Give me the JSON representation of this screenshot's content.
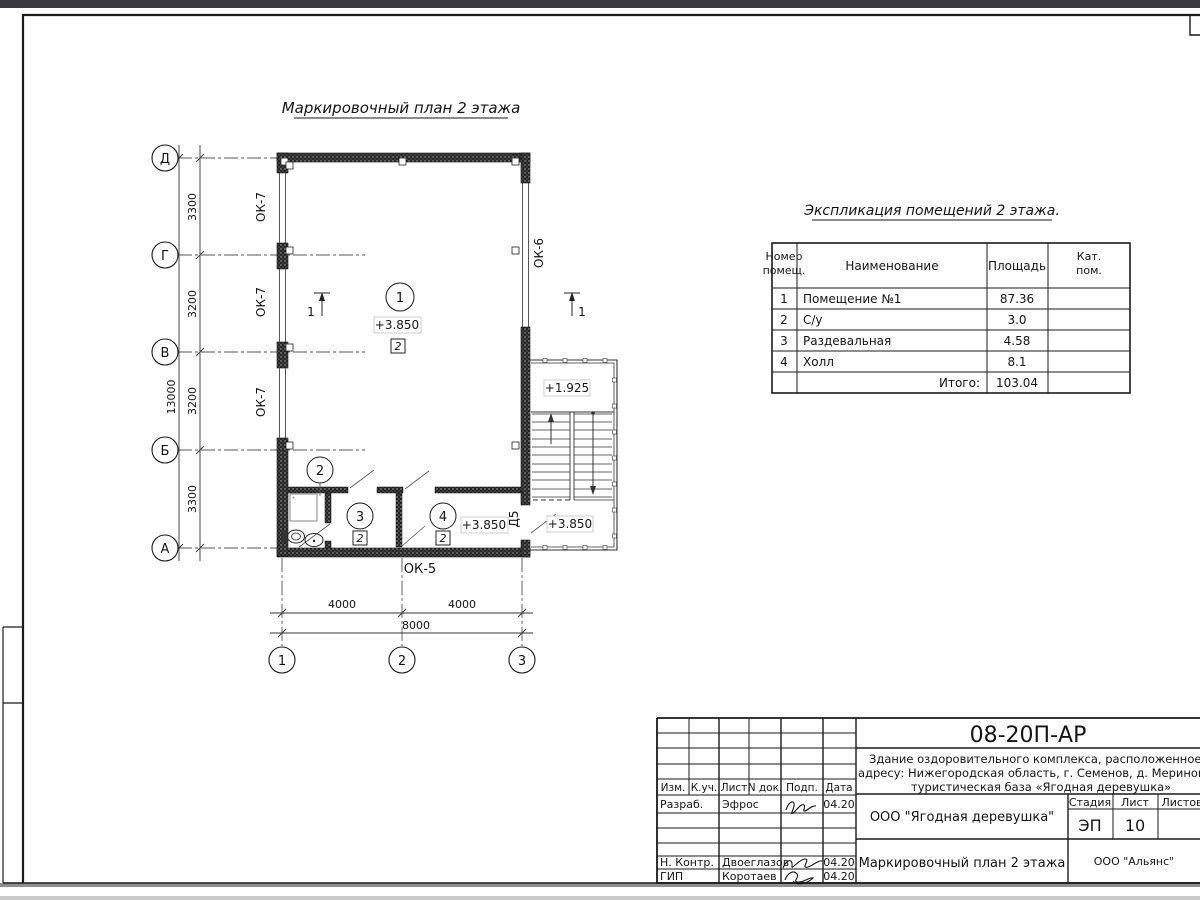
{
  "page": {
    "top_strip_color": "#3a3a3e",
    "paper_color": "#ffffff",
    "line_color": "#1a1a1a",
    "edge_band_color": "#8f8f8f",
    "outer_band_color": "#c9c9c9"
  },
  "plan": {
    "title": "Маркировочный план 2 этажа",
    "row_axes": [
      "Д",
      "Г",
      "В",
      "Б",
      "А"
    ],
    "col_axes": [
      "1",
      "2",
      "3"
    ],
    "dim_v_segments": [
      "3300",
      "3200",
      "3200",
      "3300"
    ],
    "dim_v_total": "13000",
    "dim_h_segments": [
      "4000",
      "4000"
    ],
    "dim_h_total": "8000",
    "window_left": [
      "ОК-7",
      "ОК-7",
      "ОК-7"
    ],
    "window_right": "ОК-6",
    "window_bottom": "ОК-5",
    "door": "Д5",
    "room_numbers": [
      "1",
      "2",
      "3",
      "4"
    ],
    "category_marks": [
      "2",
      "2",
      "2"
    ],
    "elevation_room1": "+3.850",
    "elevation_mid_landing": "+1.925",
    "elevation_hall": "+3.850",
    "elevation_stair_landing": "+3.850",
    "section_mark": "1"
  },
  "explication": {
    "title": "Экспликация помещений 2 этажа.",
    "headers": {
      "num1": "Номер",
      "num2": "помещ.",
      "name": "Наименование",
      "area": "Площадь",
      "cat1": "Кат.",
      "cat2": "пом."
    },
    "rows": [
      {
        "n": "1",
        "name": "Помещение №1",
        "area": "87.36"
      },
      {
        "n": "2",
        "name": "С/у",
        "area": "3.0"
      },
      {
        "n": "3",
        "name": "Раздевальная",
        "area": "4.58"
      },
      {
        "n": "4",
        "name": "Холл",
        "area": "8.1"
      }
    ],
    "total_label": "Итого:",
    "total_value": "103.04"
  },
  "titleblock": {
    "code": "08-20П-АР",
    "project_line1": "Здание оздоровительного комплекса, расположенное по",
    "project_line2": "адресу: Нижегородская область, г. Семенов, д. Мериново,",
    "project_line3": "туристическая база «Ягодная деревушка»",
    "client": "ООО \"Ягодная деревушка\"",
    "stage_label": "Стадия",
    "sheet_label": "Лист",
    "sheets_label": "Листов",
    "stage": "ЭП",
    "sheet_number": "10",
    "doc_title": "Маркировочный план 2 этажа",
    "org": "ООО \"Альянс\"",
    "columns": [
      "Изм.",
      "К.уч.",
      "Лист",
      "N док.",
      "Подп.",
      "Дата"
    ],
    "roles": [
      {
        "label": "Разраб.",
        "name": "Эфрос",
        "date": "04.20"
      },
      {
        "label": "Н. Контр.",
        "name": "Двоеглазов",
        "date": "04.20"
      },
      {
        "label": "ГИП",
        "name": "Коротаев",
        "date": "04.20"
      }
    ]
  }
}
